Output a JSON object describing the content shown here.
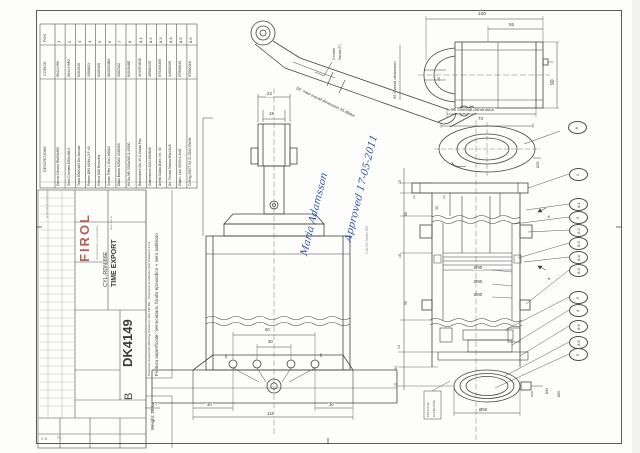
{
  "sheet": {
    "drawing_number": "DK4149",
    "revision": "B",
    "client": "TIME EXPORT",
    "object": "CYL.RDN.66E",
    "company_logo": "FIROL",
    "company_tagline": "oleodinamica e pneumatica",
    "desc_label": "descrizione",
    "qta_note": "QTA  DIS.4T6736 N.C.",
    "weight_note": "Weight: 20 kg",
    "corner_mark": "E.B.",
    "page_mark": "P.1"
  },
  "approval": {
    "line1": "Approved 17-05-2011",
    "line2": "Maria Adamsson"
  },
  "notes": {
    "pressure": "Pressione di esercizio (Working Pressure): Max 180 Bar - Pressione di collaudo (Test Pressure) 1:1.5",
    "finish": "Finitura superficiale: Verniciatura: fondo epossidico + nero sabbiato",
    "iso_note": "SE: med overall dimension 95 tillatet",
    "iso_label1": "Centrale",
    "iso_label2": "Gamba (F)",
    "stroke_note": "L=th+63  Stroke 363",
    "ptfe1": "PFE bronze",
    "ptfe2": "10.139-14-30"
  },
  "parts_table": {
    "pos_header": "POS",
    "code_header": "CODICE",
    "desc_header": "DESCRIZIONE",
    "rows": [
      {
        "pos": "1",
        "code": "0644-H90",
        "desc": "Canna Cilindro 90x80x365"
      },
      {
        "pos": "2",
        "code": "0644-H9P2",
        "desc": "Stelo Cromato Ø30x468.5"
      },
      {
        "pos": "3",
        "code": "5404045",
        "desc": "Testa 80x91x60 Din Acciaio"
      },
      {
        "pos": "4",
        "code": "3300813",
        "desc": "Pistone Ø80 M26x1.5 P-40"
      },
      {
        "pos": "5",
        "code": "6100405",
        "desc": "Ghiera M46 Bronzina"
      },
      {
        "pos": "6",
        "code": "0615033B6",
        "desc": "Snodo 7H6s 1.30x1 M90x2"
      },
      {
        "pos": "7",
        "code": "3302302",
        "desc": "Dado Basso M30x2  UNI5589"
      },
      {
        "pos": "8",
        "code": "8404046E",
        "desc": "Kit Gu.NR 3248x040-5-40000"
      },
      {
        "pos": "8.1",
        "code": "1H45T3845",
        "desc": "Raschiatore DU 40 C.Guida Fas."
      },
      {
        "pos": "8.2",
        "code": "30500415",
        "desc": "Guarnizione AUN 45x50x8"
      },
      {
        "pos": "8.3",
        "code": "5T5400305",
        "desc": "Anello Guida Diam. Int. 40"
      },
      {
        "pos": "8.4",
        "code": "34000105",
        "desc": "An. Tenuta Stanca 80x4 A45"
      },
      {
        "pos": "8.5",
        "code": "5T000045",
        "desc": "Guarn. Led. 80/90 4.2x40"
      },
      {
        "pos": "8.6",
        "code": "5T000116",
        "desc": "O-Ring 2087T/18 21.52x3.53x3H"
      }
    ]
  },
  "balloons": [
    "6",
    "1",
    "8.1",
    "3",
    "8.2",
    "8.3",
    "8.4",
    "8.3",
    "2",
    "4",
    "8.6",
    "8.5",
    "5"
  ],
  "dimensions": {
    "k22": "22",
    "k19": "19",
    "k100": "100",
    "k55": "55",
    "k90": "90",
    "k95r": "95 Overall dimension",
    "k95b": "95 Overall dimension",
    "k73": "73",
    "k25": "Ø25",
    "k45": "45",
    "k60": "60",
    "k30m": "30",
    "k30l": "30",
    "k30r": "30",
    "k118": "118",
    "k2": "2",
    "k90d": "Ø90",
    "k80a": "Ø80",
    "k80b": "Ø80",
    "k50": "Ø50",
    "k13": "Ø13",
    "k20": "Ø20",
    "kr18": "R1/8",
    "k15a": "15",
    "k88": "88",
    "k4a": "(4)",
    "k30s": "30",
    "k4b": "(4)",
    "k18": "18",
    "k95s": "95",
    "k14": "14",
    "k34": "34",
    "k15b": "15",
    "kA1": "A",
    "kA2": "A",
    "k8a": "Ø8",
    "k8b": "Ø8"
  },
  "colors": {
    "ink": "#3c3c3c",
    "blue": "#2f54b0",
    "logo": "#b66156"
  }
}
